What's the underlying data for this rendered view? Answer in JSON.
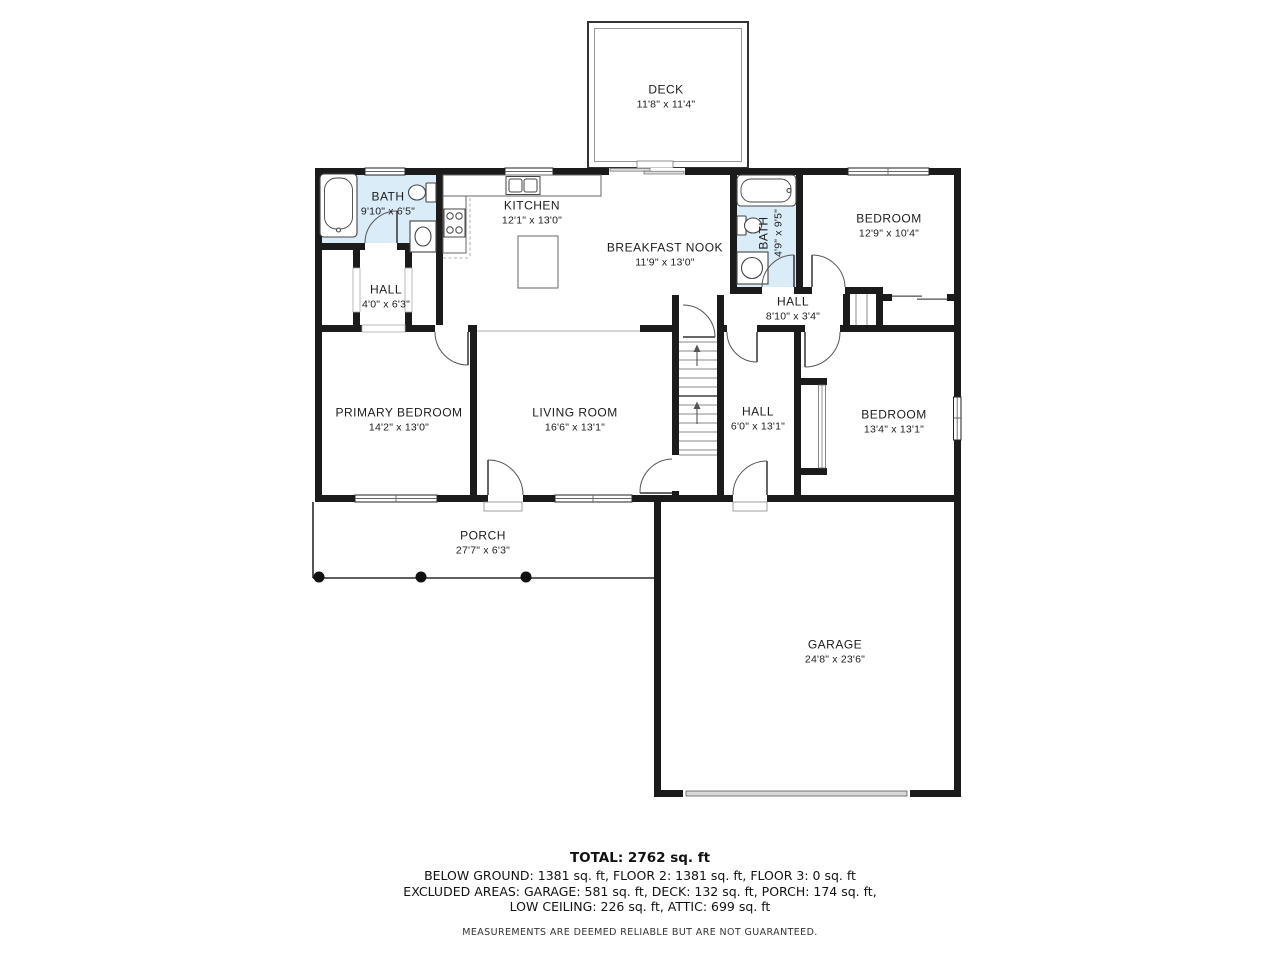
{
  "rooms": {
    "deck": {
      "name": "DECK",
      "dims": "11'8\" x 11'4\""
    },
    "bath_main": {
      "name": "BATH",
      "dims": "9'10\" x 6'5\""
    },
    "kitchen": {
      "name": "KITCHEN",
      "dims": "12'1\" x 13'0\""
    },
    "breakfast_nook": {
      "name": "BREAKFAST NOOK",
      "dims": "11'9\" x 13'0\""
    },
    "bath_hall": {
      "name": "BATH",
      "dims": "4'9\" x 9'5\""
    },
    "bedroom_upper": {
      "name": "BEDROOM",
      "dims": "12'9\" x 10'4\""
    },
    "hall_small": {
      "name": "HALL",
      "dims": "4'0\" x 6'3\""
    },
    "hall_upper": {
      "name": "HALL",
      "dims": "8'10\" x 3'4\""
    },
    "primary_bedroom": {
      "name": "PRIMARY BEDROOM",
      "dims": "14'2\" x 13'0\""
    },
    "living_room": {
      "name": "LIVING ROOM",
      "dims": "16'6\" x 13'1\""
    },
    "hall_lower": {
      "name": "HALL",
      "dims": "6'0\" x 13'1\""
    },
    "bedroom_lower": {
      "name": "BEDROOM",
      "dims": "13'4\" x 13'1\""
    },
    "porch": {
      "name": "PORCH",
      "dims": "27'7\" x 6'3\""
    },
    "garage": {
      "name": "GARAGE",
      "dims": "24'8\" x 23'6\""
    }
  },
  "summary": {
    "total": "TOTAL: 2762 sq. ft",
    "areas_line": "BELOW GROUND: 1381 sq. ft, FLOOR 2: 1381 sq. ft, FLOOR 3: 0 sq. ft",
    "excluded_line1": "EXCLUDED AREAS: GARAGE: 581 sq. ft, DECK: 132 sq. ft, PORCH: 174 sq. ft,",
    "excluded_line2": "LOW CEILING: 226 sq. ft, ATTIC: 699 sq. ft",
    "disclaimer": "MEASUREMENTS ARE DEEMED RELIABLE BUT ARE NOT GUARANTEED."
  },
  "colors": {
    "wall": "#1b1b1b",
    "bath_fill": "#d9ecf8",
    "background": "#ffffff"
  }
}
